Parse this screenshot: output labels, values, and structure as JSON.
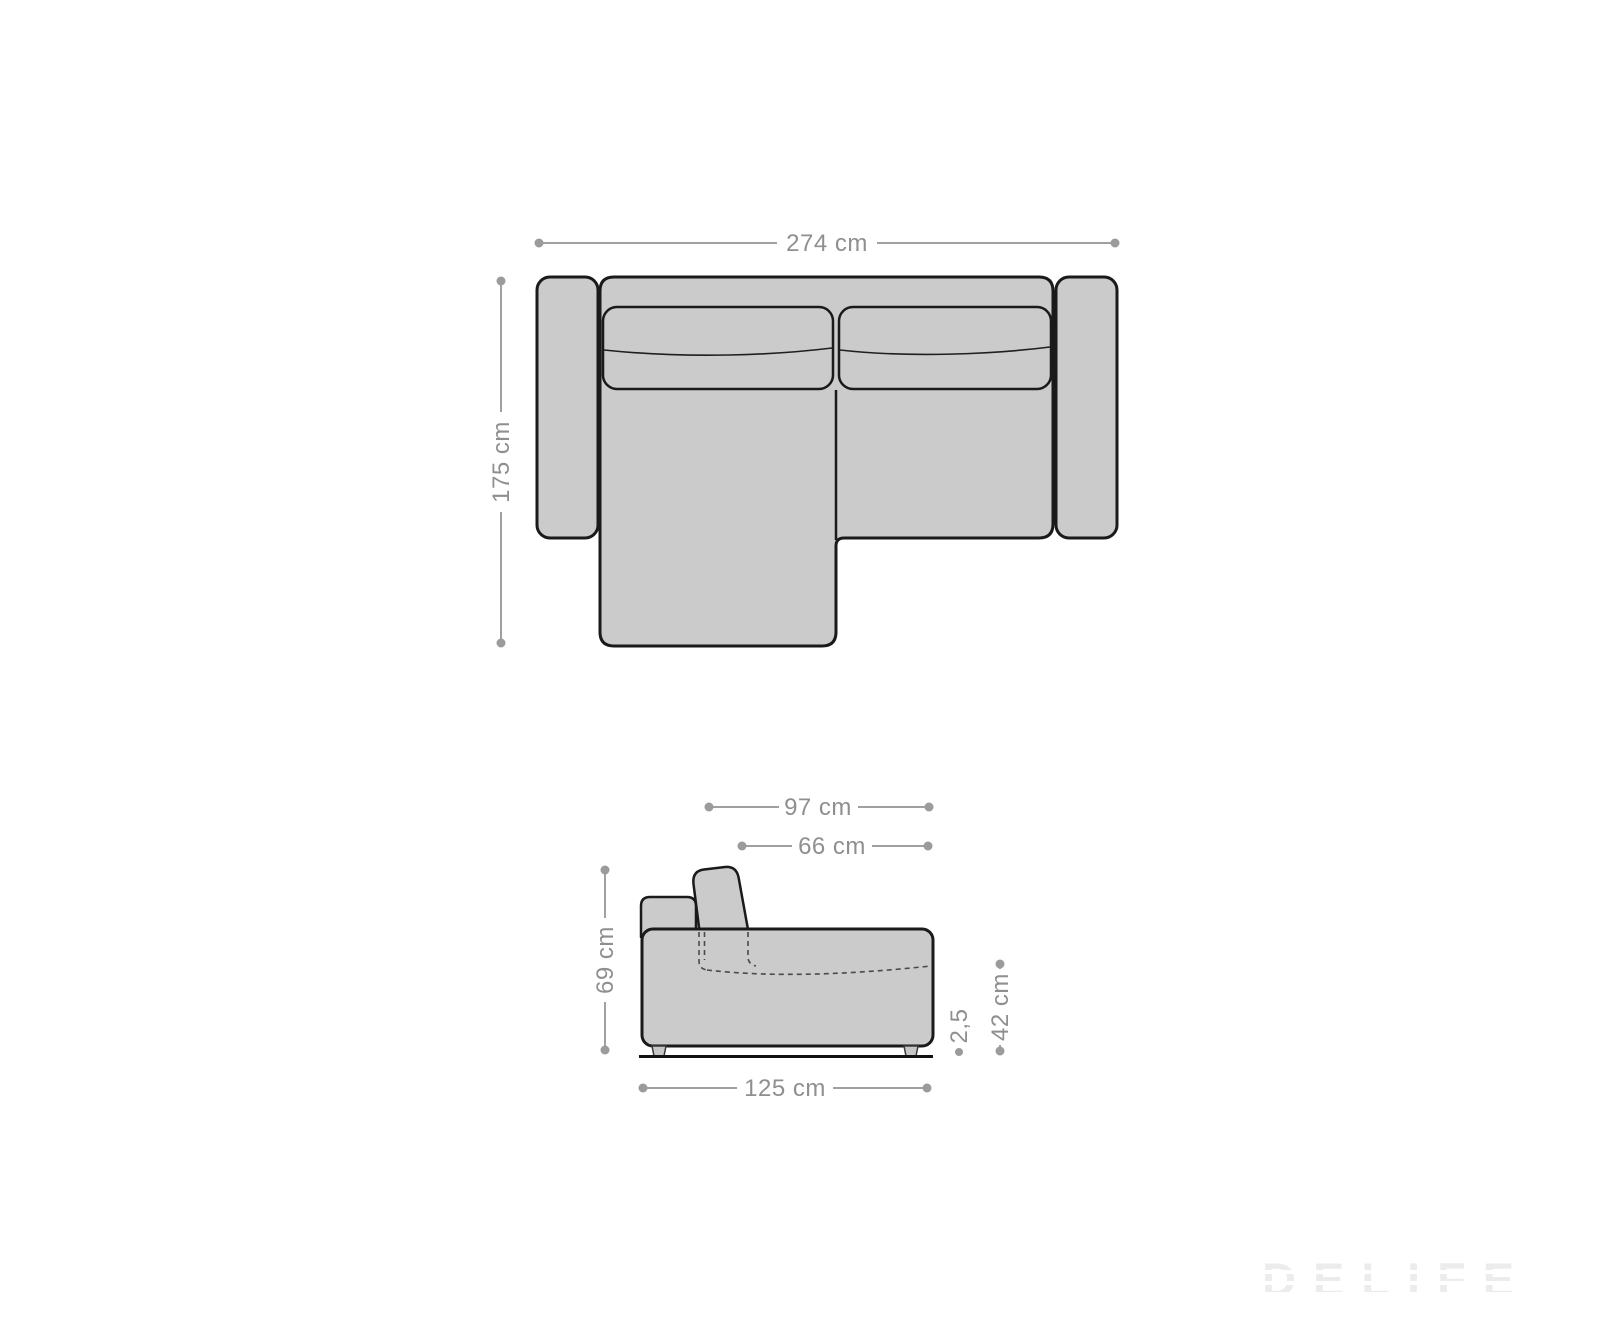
{
  "diagram": {
    "type": "sofa-dimension-drawing",
    "views": [
      "top-view",
      "side-view"
    ]
  },
  "dims": {
    "top_width": "274 cm",
    "top_depth": "175 cm",
    "side_back_depth": "97 cm",
    "side_seat_depth": "66 cm",
    "side_back_height": "69 cm",
    "side_seat_height": "42 cm",
    "side_base_height": "2,5",
    "side_total_depth": "125 cm"
  },
  "watermark": {
    "brand": "DELIFE"
  },
  "colors": {
    "background": "#ffffff",
    "sofa_fill": "#cbcbcb",
    "sofa_outline": "#1a1a1a",
    "dimension_gray": "#9b9b9b",
    "watermark_gray": "#ececec"
  }
}
